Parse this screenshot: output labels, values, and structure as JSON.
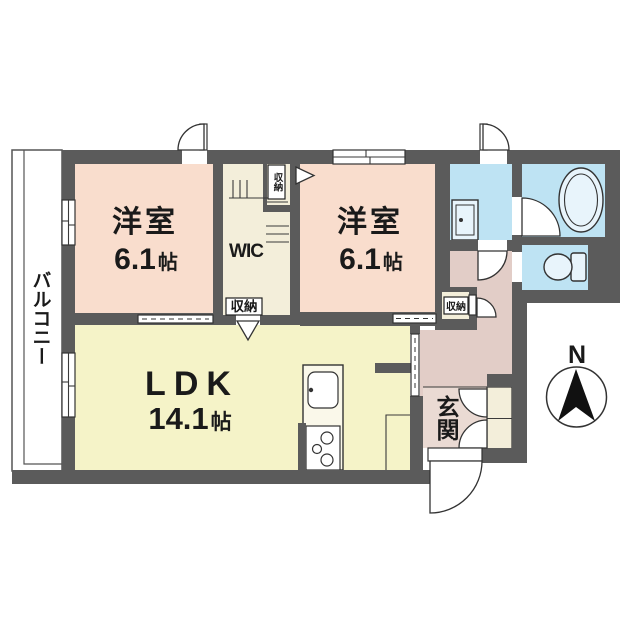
{
  "floorplan": {
    "rooms": {
      "bedroom1": {
        "name": "洋室",
        "area": "6.1",
        "unit": "帖"
      },
      "bedroom2": {
        "name": "洋室",
        "area": "6.1",
        "unit": "帖"
      },
      "ldk": {
        "name": "LDK",
        "area": "14.1",
        "unit": "帖"
      },
      "wic": {
        "name": "WIC"
      },
      "balcony": {
        "name": "バルコニー"
      },
      "entrance": {
        "name": "玄関"
      }
    },
    "storage_label": "収納",
    "compass": {
      "north_label": "N"
    },
    "colors": {
      "wall": "#5B5B5B",
      "bedroom": "#F9DDCD",
      "ldk": "#F5F3C8",
      "storage": "#F3EEDA",
      "hallway": "#E2CDC7",
      "entrance_floor": "#EADAD3",
      "wet_area": "#BEE3F3",
      "fixture_fill": "#E8F4FB",
      "balcony": "#FFFFFF"
    }
  }
}
